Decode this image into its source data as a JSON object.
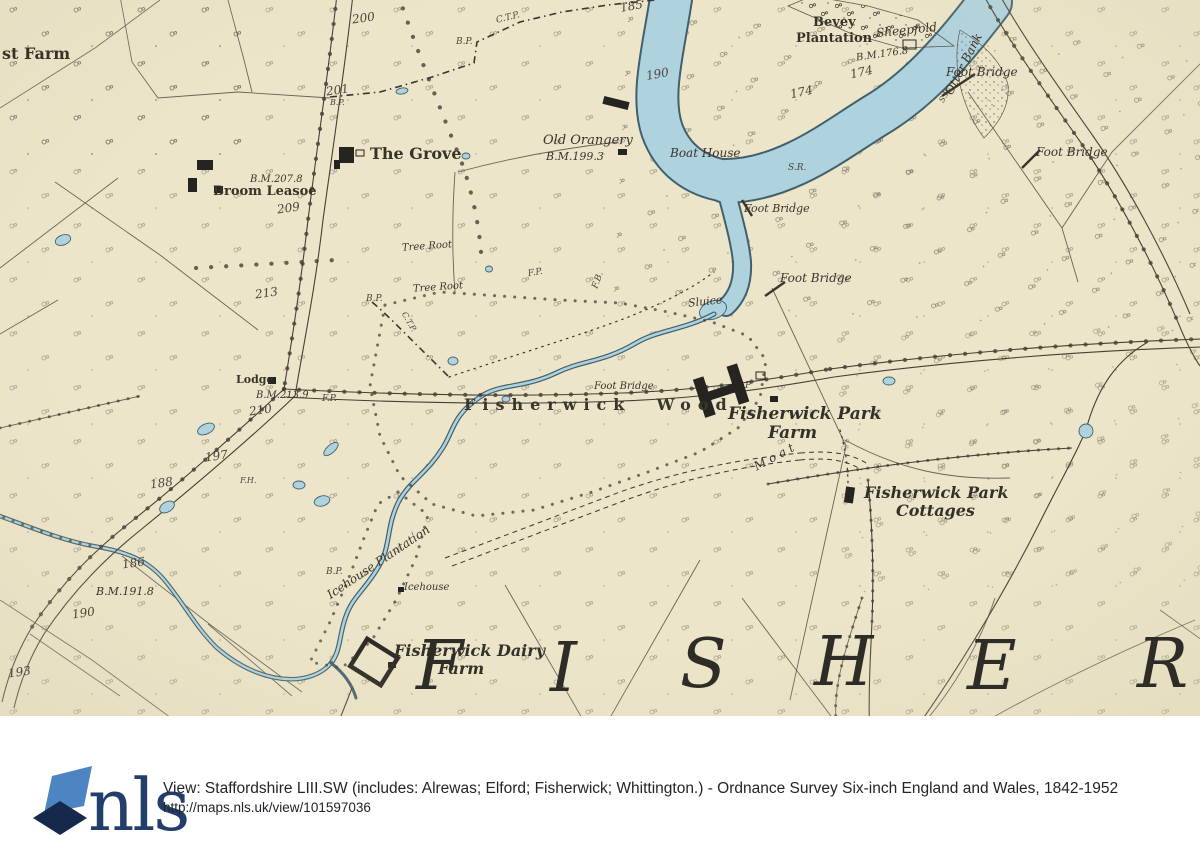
{
  "colors": {
    "paper": "#ece5c9",
    "ink": "#453f35",
    "ink_light": "#5b5448",
    "water": "#afd2df",
    "water_edge": "#41606b",
    "wood_ink": "#4a443a",
    "giant_ink": "#2e2c27",
    "logo_light": "#4d85c3",
    "logo_dark": "#16294d",
    "logo_text_color": "#223e6b",
    "footer_text": "#23242b"
  },
  "footer": {
    "logo_text": "nls",
    "title": "View: Staffordshire LIII.SW (includes: Alrewas; Elford; Fisherwick; Whittington.) - Ordnance Survey Six-inch England and Wales, 1842-1952",
    "url": "http://maps.nls.uk/view/101597036"
  },
  "map_labels": [
    {
      "text": "st Farm",
      "cls": "rm",
      "x": 2,
      "y": 46,
      "size": 16
    },
    {
      "text": "200",
      "cls": "num",
      "x": 352,
      "y": 12,
      "size": 12,
      "rot": -8
    },
    {
      "text": "C.T.P.",
      "cls": "tiny",
      "x": 496,
      "y": 14,
      "size": 9,
      "rot": -14
    },
    {
      "text": "B.P.",
      "cls": "tiny",
      "x": 456,
      "y": 38,
      "size": 9
    },
    {
      "text": "185",
      "cls": "num",
      "x": 620,
      "y": 0,
      "size": 12,
      "rot": -10
    },
    {
      "text": "190",
      "cls": "num",
      "x": 646,
      "y": 68,
      "size": 12,
      "rot": -10
    },
    {
      "text": "201",
      "cls": "num",
      "x": 326,
      "y": 84,
      "size": 12,
      "rot": -8
    },
    {
      "text": "B.P.",
      "cls": "tiny",
      "x": 330,
      "y": 99,
      "size": 8
    },
    {
      "text": "Bevey",
      "cls": "rm",
      "x": 813,
      "y": 16,
      "size": 13
    },
    {
      "text": "Plantation",
      "cls": "rm",
      "x": 796,
      "y": 32,
      "size": 13
    },
    {
      "text": "Sheepfold",
      "cls": "it",
      "x": 876,
      "y": 24,
      "size": 12,
      "rot": -6
    },
    {
      "text": "B.M.176.8",
      "cls": "it",
      "x": 856,
      "y": 50,
      "size": 10,
      "rot": -8
    },
    {
      "text": "Otter Bank",
      "cls": "it",
      "x": 930,
      "y": 58,
      "size": 12,
      "rot": -63
    },
    {
      "text": "174",
      "cls": "num",
      "x": 850,
      "y": 66,
      "size": 12,
      "rot": -12
    },
    {
      "text": "174",
      "cls": "num",
      "x": 790,
      "y": 86,
      "size": 12,
      "rot": -12
    },
    {
      "text": "Foot Bridge",
      "cls": "it",
      "x": 946,
      "y": 66,
      "size": 12
    },
    {
      "text": "S.P.",
      "cls": "tiny",
      "x": 938,
      "y": 92,
      "size": 8,
      "rot": -60
    },
    {
      "text": "Foot Bridge",
      "cls": "it",
      "x": 1036,
      "y": 146,
      "size": 12
    },
    {
      "text": "Old Orangery",
      "cls": "it",
      "x": 543,
      "y": 134,
      "size": 13
    },
    {
      "text": "B.M.199.3",
      "cls": "it",
      "x": 546,
      "y": 151,
      "size": 11
    },
    {
      "text": "Boat House",
      "cls": "it",
      "x": 670,
      "y": 147,
      "size": 12
    },
    {
      "text": "S.R.",
      "cls": "tiny",
      "x": 788,
      "y": 164,
      "size": 9
    },
    {
      "text": "Foot Bridge",
      "cls": "it",
      "x": 744,
      "y": 203,
      "size": 11
    },
    {
      "text": "Foot Bridge",
      "cls": "it",
      "x": 780,
      "y": 272,
      "size": 12
    },
    {
      "text": "Sluice",
      "cls": "it",
      "x": 688,
      "y": 296,
      "size": 11,
      "rot": -6
    },
    {
      "text": "The Grove",
      "cls": "rm",
      "x": 370,
      "y": 146,
      "size": 16
    },
    {
      "text": "B.M.207.8",
      "cls": "it",
      "x": 250,
      "y": 175,
      "size": 10
    },
    {
      "text": "Broom Leasoe",
      "cls": "rm",
      "x": 213,
      "y": 185,
      "size": 13
    },
    {
      "text": "209",
      "cls": "num",
      "x": 277,
      "y": 202,
      "size": 12,
      "rot": -8
    },
    {
      "text": "213",
      "cls": "num",
      "x": 255,
      "y": 287,
      "size": 12,
      "rot": -8
    },
    {
      "text": "Tree Root",
      "cls": "it",
      "x": 402,
      "y": 242,
      "size": 10,
      "rot": -4
    },
    {
      "text": "Tree Root",
      "cls": "it",
      "x": 413,
      "y": 283,
      "size": 10,
      "rot": -4
    },
    {
      "text": "B.P.",
      "cls": "tiny",
      "x": 366,
      "y": 295,
      "size": 9
    },
    {
      "text": "C.T.P.",
      "cls": "tiny",
      "x": 398,
      "y": 318,
      "size": 8,
      "rot": 60
    },
    {
      "text": "F.P.",
      "cls": "tiny",
      "x": 528,
      "y": 269,
      "size": 9,
      "rot": -10
    },
    {
      "text": "F.B.",
      "cls": "tiny",
      "x": 590,
      "y": 276,
      "size": 9,
      "rot": -70
    },
    {
      "text": "Lodge",
      "cls": "rm",
      "x": 236,
      "y": 374,
      "size": 11
    },
    {
      "text": "B.M.213.9",
      "cls": "it",
      "x": 256,
      "y": 391,
      "size": 10
    },
    {
      "text": "F.P.",
      "cls": "tiny",
      "x": 322,
      "y": 395,
      "size": 9
    },
    {
      "text": "210",
      "cls": "num",
      "x": 249,
      "y": 404,
      "size": 12,
      "rot": -8
    },
    {
      "text": "197",
      "cls": "num",
      "x": 205,
      "y": 450,
      "size": 12,
      "rot": -8
    },
    {
      "text": "F.H.",
      "cls": "tiny",
      "x": 240,
      "y": 477,
      "size": 8
    },
    {
      "text": "188",
      "cls": "num",
      "x": 150,
      "y": 477,
      "size": 12,
      "rot": -8
    },
    {
      "text": "186",
      "cls": "num",
      "x": 122,
      "y": 557,
      "size": 12,
      "rot": -8
    },
    {
      "text": "B.M.191.8",
      "cls": "it",
      "x": 96,
      "y": 586,
      "size": 11
    },
    {
      "text": "190",
      "cls": "num",
      "x": 72,
      "y": 607,
      "size": 12,
      "rot": -8
    },
    {
      "text": "193",
      "cls": "num",
      "x": 8,
      "y": 666,
      "size": 12,
      "rot": -8
    },
    {
      "text": "Icehouse Plantation",
      "cls": "it",
      "x": 318,
      "y": 556,
      "size": 12,
      "rot": -34
    },
    {
      "text": "Icehouse",
      "cls": "it",
      "x": 404,
      "y": 583,
      "size": 10
    },
    {
      "text": "B.P.",
      "cls": "tiny",
      "x": 326,
      "y": 568,
      "size": 9
    },
    {
      "text": "Fisherwick  Wood",
      "cls": "sp",
      "x": 464,
      "y": 397,
      "size": 16,
      "ls": 7
    },
    {
      "text": "Foot Bridge",
      "cls": "it",
      "x": 594,
      "y": 382,
      "size": 10
    },
    {
      "text": "P",
      "cls": "tiny",
      "x": 745,
      "y": 382,
      "size": 9
    },
    {
      "text": "Fisherwick Park",
      "cls": "itb",
      "x": 728,
      "y": 406,
      "size": 17
    },
    {
      "text": "Farm",
      "cls": "itb",
      "x": 768,
      "y": 425,
      "size": 17
    },
    {
      "text": "Moat",
      "cls": "it",
      "x": 752,
      "y": 450,
      "size": 12,
      "rot": -28,
      "ls": 4
    },
    {
      "text": "Fisherwick Park",
      "cls": "itb",
      "x": 864,
      "y": 485,
      "size": 16
    },
    {
      "text": "Cottages",
      "cls": "itb",
      "x": 896,
      "y": 503,
      "size": 16
    },
    {
      "text": "Fisherwick Dairy",
      "cls": "itb",
      "x": 394,
      "y": 643,
      "size": 16
    },
    {
      "text": "Farm",
      "cls": "itb",
      "x": 438,
      "y": 661,
      "size": 16
    },
    {
      "text": "F",
      "cls": "giant",
      "x": 416,
      "y": 633,
      "size": 68
    },
    {
      "text": "I",
      "cls": "giant",
      "x": 550,
      "y": 635,
      "size": 68
    },
    {
      "text": "S",
      "cls": "giant",
      "x": 680,
      "y": 631,
      "size": 68
    },
    {
      "text": "H",
      "cls": "giant",
      "x": 814,
      "y": 629,
      "size": 68
    },
    {
      "text": "E",
      "cls": "giant",
      "x": 967,
      "y": 633,
      "size": 68
    },
    {
      "text": "R",
      "cls": "giant",
      "x": 1137,
      "y": 631,
      "size": 68
    }
  ]
}
